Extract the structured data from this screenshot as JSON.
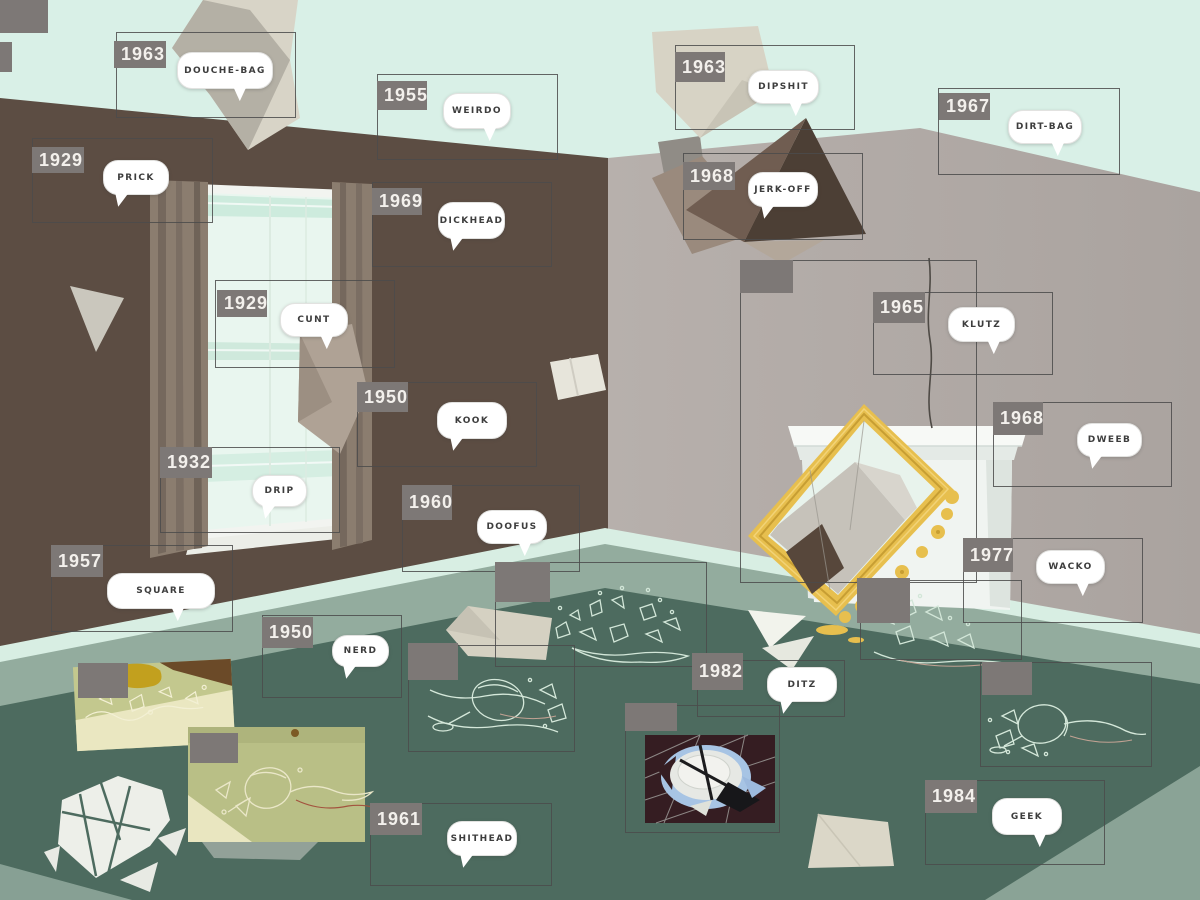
{
  "scene_title": "room interior with flying papers and broken objects, annotated with insult words by year",
  "palette": {
    "ceiling_mint": "#d9f0e7",
    "left_wall_brown": "#5c4d43",
    "right_wall_gray": "#b2aba7",
    "floor_green": "#4d6b5f",
    "baseboard_mint": "#d8eee3",
    "floor_sage": "#93ac9e",
    "tab_gray": "#7d7876",
    "box_outline": "#4b4b4b",
    "bubble_white": "#ffffff",
    "bubble_text": "#3d3d3d",
    "mirror_gold": "#e7bf4e",
    "glass_lineart": "#d2e6d8"
  },
  "hotspots": [
    {
      "year": "1963",
      "word": "DOUCHE-BAG",
      "box": [
        116,
        32,
        180,
        86
      ],
      "tab": [
        114,
        41,
        52,
        27
      ],
      "bubble": [
        177,
        52,
        94,
        35
      ],
      "tail": "r"
    },
    {
      "year": "1955",
      "word": "WEIRDO",
      "box": [
        377,
        74,
        181,
        86
      ],
      "tab": [
        377,
        81,
        50,
        29
      ],
      "bubble": [
        443,
        93,
        66,
        34
      ],
      "tail": "r"
    },
    {
      "year": "1963",
      "word": "DIPSHIT",
      "box": [
        675,
        45,
        180,
        85
      ],
      "tab": [
        675,
        52,
        50,
        30
      ],
      "bubble": [
        748,
        70,
        69,
        32
      ],
      "tail": "r"
    },
    {
      "year": "1967",
      "word": "DIRT-BAG",
      "box": [
        938,
        88,
        182,
        87
      ],
      "tab": [
        939,
        93,
        51,
        27
      ],
      "bubble": [
        1008,
        110,
        72,
        32
      ],
      "tail": "r"
    },
    {
      "year": "1929",
      "word": "PRICK",
      "box": [
        32,
        138,
        181,
        85
      ],
      "tab": [
        32,
        147,
        52,
        26
      ],
      "bubble": [
        103,
        160,
        64,
        33
      ],
      "tail": "l"
    },
    {
      "year": "1969",
      "word": "DICKHEAD",
      "box": [
        372,
        182,
        180,
        85
      ],
      "tab": [
        372,
        188,
        50,
        27
      ],
      "bubble": [
        438,
        202,
        65,
        35
      ],
      "tail": "l"
    },
    {
      "year": "1968",
      "word": "JERK-OFF",
      "box": [
        683,
        153,
        180,
        87
      ],
      "tab": [
        683,
        162,
        52,
        28
      ],
      "bubble": [
        748,
        172,
        68,
        33
      ],
      "tail": "l"
    },
    {
      "year": "1929",
      "word": "CUNT",
      "box": [
        215,
        280,
        180,
        88
      ],
      "tab": [
        217,
        290,
        50,
        27
      ],
      "bubble": [
        280,
        303,
        66,
        32
      ],
      "tail": "r"
    },
    {
      "year": "1965",
      "word": "KLUTZ",
      "box": [
        873,
        292,
        180,
        83
      ],
      "tab": [
        873,
        292,
        52,
        31
      ],
      "bubble": [
        948,
        307,
        65,
        33
      ],
      "tail": "r"
    },
    {
      "year": "1950",
      "word": "KOOK",
      "box": [
        357,
        382,
        180,
        85
      ],
      "tab": [
        357,
        382,
        51,
        30
      ],
      "bubble": [
        437,
        402,
        68,
        35
      ],
      "tail": "l"
    },
    {
      "year": "1968",
      "word": "DWEEB",
      "box": [
        993,
        402,
        179,
        85
      ],
      "tab": [
        993,
        402,
        50,
        33
      ],
      "bubble": [
        1077,
        423,
        63,
        32
      ],
      "tail": "l"
    },
    {
      "year": "1932",
      "word": "DRIP",
      "box": [
        160,
        447,
        180,
        86
      ],
      "tab": [
        160,
        447,
        52,
        31
      ],
      "bubble": [
        252,
        475,
        53,
        30
      ],
      "tail": "l"
    },
    {
      "year": "1960",
      "word": "DOOFUS",
      "box": [
        402,
        485,
        178,
        87
      ],
      "tab": [
        402,
        485,
        50,
        35
      ],
      "bubble": [
        477,
        510,
        68,
        32
      ],
      "tail": "r"
    },
    {
      "year": "1977",
      "word": "WACKO",
      "box": [
        963,
        538,
        180,
        85
      ],
      "tab": [
        963,
        538,
        50,
        34
      ],
      "bubble": [
        1036,
        550,
        67,
        32
      ],
      "tail": "r"
    },
    {
      "year": "1957",
      "word": "SQUARE",
      "box": [
        51,
        545,
        182,
        87
      ],
      "tab": [
        51,
        545,
        52,
        32
      ],
      "bubble": [
        107,
        573,
        106,
        34
      ],
      "tail": "r"
    },
    {
      "year": "1950",
      "word": "NERD",
      "box": [
        262,
        615,
        140,
        83
      ],
      "tab": [
        262,
        617,
        51,
        31
      ],
      "bubble": [
        332,
        635,
        55,
        30
      ],
      "tail": "l"
    },
    {
      "year": "1982",
      "word": "DITZ",
      "box": [
        697,
        660,
        148,
        57
      ],
      "tab": [
        692,
        653,
        51,
        37
      ],
      "bubble": [
        767,
        667,
        68,
        33
      ],
      "tail": "l"
    },
    {
      "year": "1961",
      "word": "SHITHEAD",
      "box": [
        370,
        803,
        182,
        83
      ],
      "tab": [
        370,
        803,
        52,
        32
      ],
      "bubble": [
        447,
        821,
        68,
        33
      ],
      "tail": "l"
    },
    {
      "year": "1984",
      "word": "GEEK",
      "box": [
        925,
        780,
        180,
        85
      ],
      "tab": [
        925,
        780,
        52,
        33
      ],
      "bubble": [
        992,
        798,
        68,
        35
      ],
      "tail": "r"
    }
  ],
  "unlabeled_hotspots": [
    {
      "box": [
        740,
        260,
        237,
        323
      ],
      "tab": [
        740,
        260,
        53,
        33
      ]
    },
    {
      "box": [
        495,
        562,
        212,
        105
      ],
      "tab": [
        495,
        562,
        55,
        40
      ]
    },
    {
      "box": [
        408,
        645,
        167,
        107
      ],
      "tab": [
        408,
        643,
        50,
        37
      ]
    },
    {
      "box": [
        625,
        705,
        155,
        128
      ],
      "tab": [
        625,
        703,
        52,
        28
      ]
    },
    {
      "box": [
        980,
        662,
        172,
        105
      ],
      "tab": [
        982,
        662,
        50,
        33
      ]
    },
    {
      "box": [
        860,
        580,
        162,
        80
      ],
      "tab": [
        857,
        578,
        53,
        45
      ]
    },
    {
      "tab": [
        78,
        663,
        50,
        35
      ]
    },
    {
      "tab": [
        190,
        733,
        48,
        30
      ]
    },
    {
      "tab": [
        0,
        0,
        48,
        33
      ]
    },
    {
      "tab": [
        0,
        42,
        12,
        30
      ]
    }
  ]
}
